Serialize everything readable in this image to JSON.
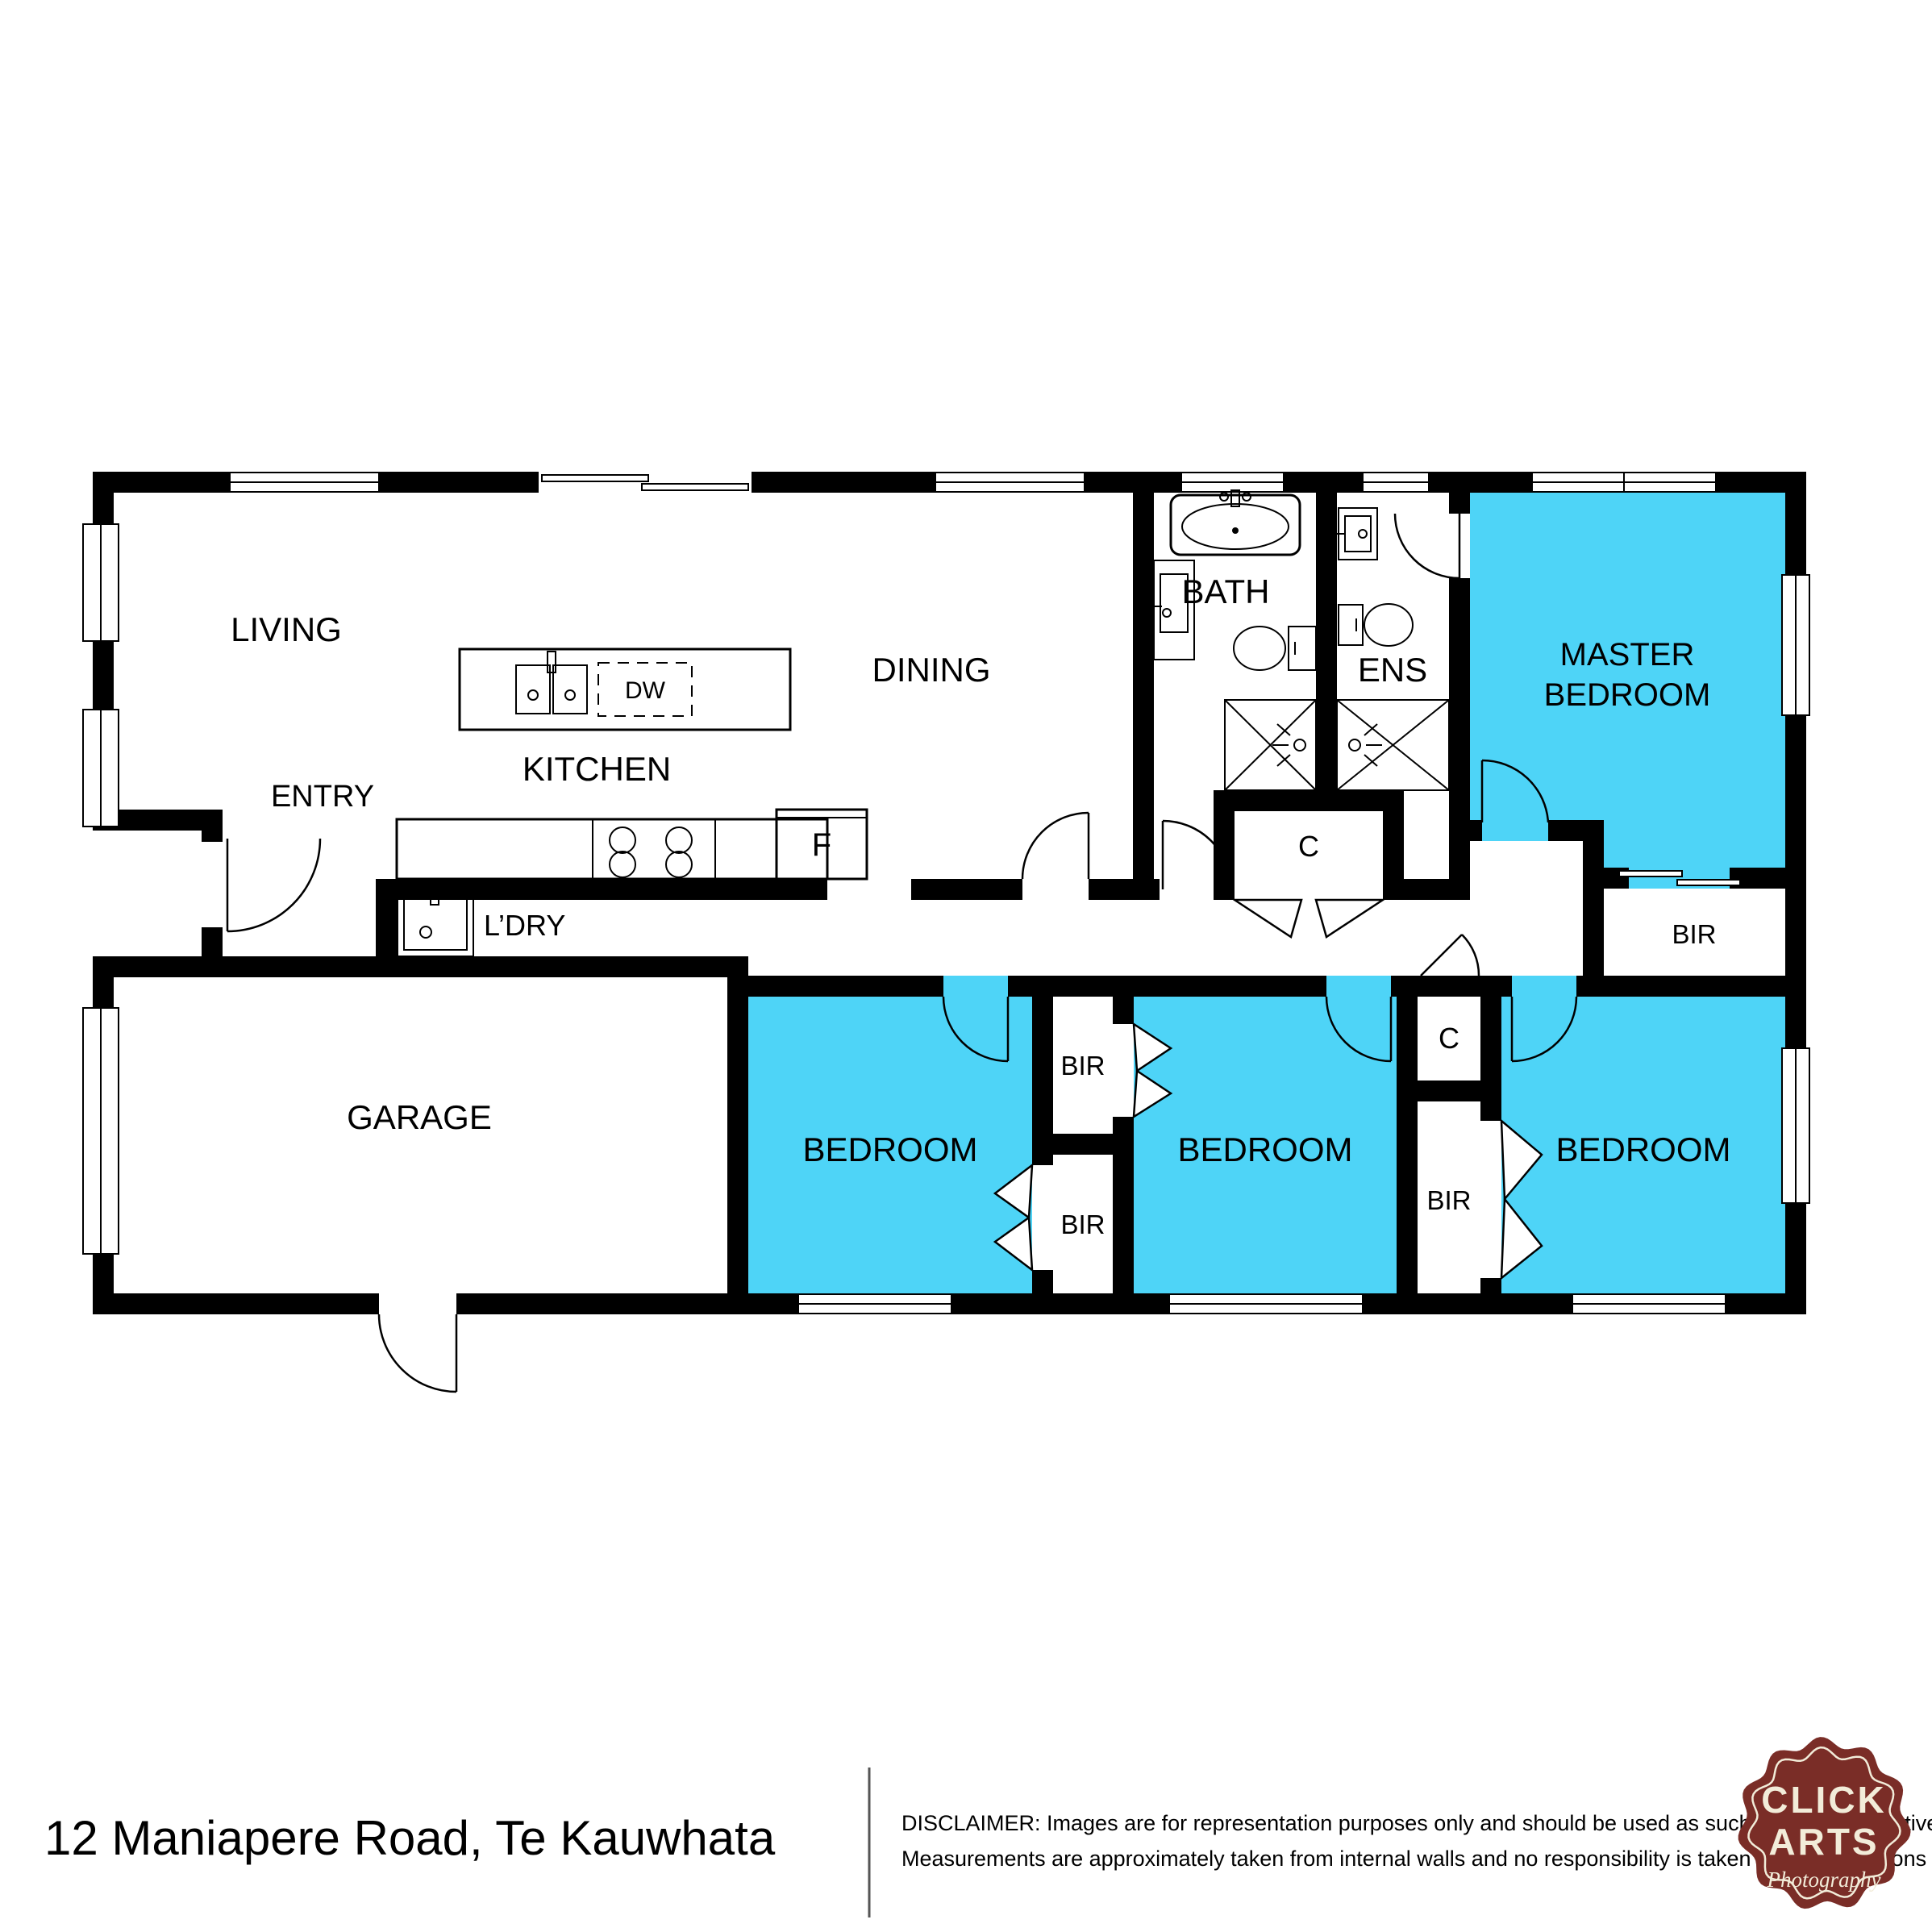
{
  "colors": {
    "room_fill": "#4ed4f7",
    "wall": "#000000",
    "logo_bg": "#7a2d27",
    "logo_fg": "#f2ecd9"
  },
  "rooms": {
    "living": "LIVING",
    "entry": "ENTRY",
    "kitchen": "KITCHEN",
    "dining": "DINING",
    "bath": "BATH",
    "ensuite": "ENS",
    "master_line1": "MASTER",
    "master_line2": "BEDROOM",
    "laundry": "L’DRY",
    "garage": "GARAGE",
    "bedroom": "BEDROOM",
    "built_in_robe": "BIR",
    "closet": "C",
    "dishwasher": "DW",
    "fridge": "F"
  },
  "footer": {
    "address": "12 Maniapere Road, Te Kauwhata",
    "disclaimer_line1": "DISCLAIMER: Images are for representation purposes only and should be used as such by any prospective buyer.",
    "disclaimer_line2": "Measurements are approximately taken from internal walls and no responsibility is taken for any omissions or errors."
  },
  "logo": {
    "line1": "CLICK",
    "line2": "ARTS",
    "tagline": "Photography"
  }
}
